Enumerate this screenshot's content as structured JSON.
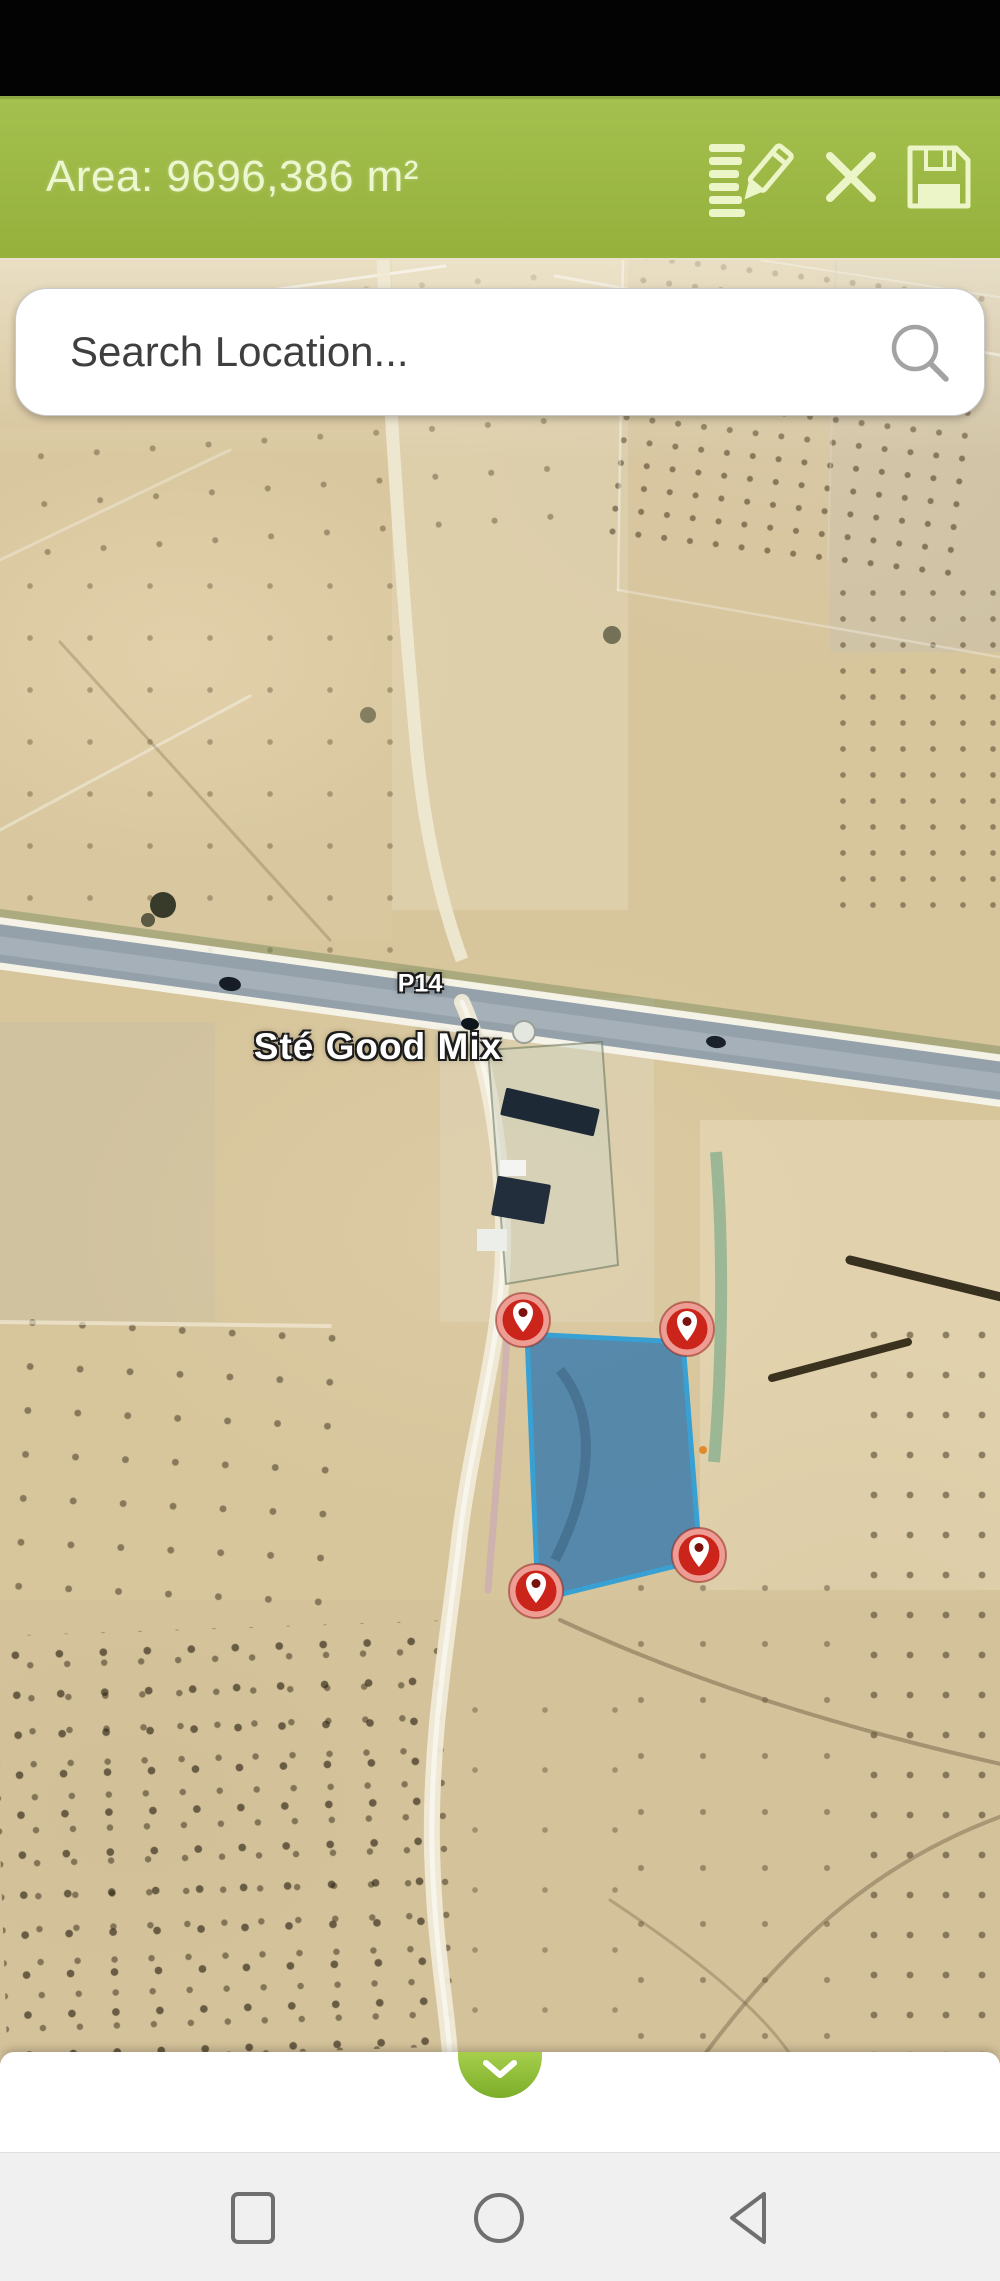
{
  "header": {
    "area_text": "Area: 9696,386 m²",
    "bg_color": "#9bb640",
    "icons": [
      "edit-note-icon",
      "close-icon",
      "save-icon"
    ]
  },
  "search": {
    "placeholder": "Search Location..."
  },
  "map": {
    "type": "satellite",
    "place_label": "Sté Good Mix",
    "road_label": "P14",
    "polygon": {
      "fill": "#4380ac",
      "stroke": "#38a0d2",
      "points": [
        [
          527,
          1074
        ],
        [
          683,
          1082
        ],
        [
          700,
          1300
        ],
        [
          538,
          1340
        ]
      ]
    },
    "markers": [
      {
        "x": 523,
        "y": 1060
      },
      {
        "x": 687,
        "y": 1069
      },
      {
        "x": 699,
        "y": 1295
      },
      {
        "x": 536,
        "y": 1331
      }
    ],
    "marker_color": "#cb241b"
  },
  "bottom_sheet": {
    "icon": "chevron-down-icon"
  },
  "navbar": {
    "items": [
      {
        "icon": "recents-icon"
      },
      {
        "icon": "home-icon"
      },
      {
        "icon": "back-icon"
      }
    ]
  }
}
